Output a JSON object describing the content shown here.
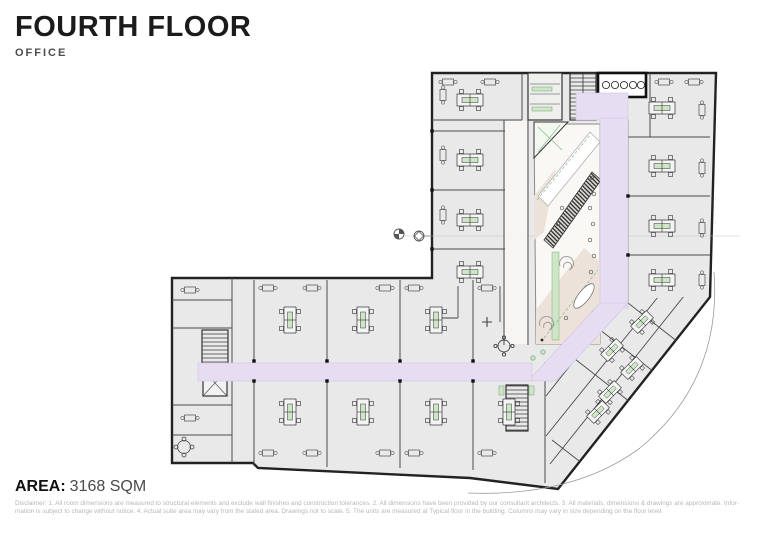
{
  "header": {
    "title": "FOURTH FLOOR",
    "subtitle": "OFFICE"
  },
  "footer": {
    "area_label": "AREA:",
    "area_value": "3168 SQM",
    "disclaimer_line1": "Disclaimer: 1. All room dimensions are measured to structural elements and exclude wall finishes and construction tolerances. 2. All dimensions have been provided by our consultant architects. 3. All materials, dimensions & drawings are approximate. Infor-",
    "disclaimer_line2": "mation is subject to change without notice. 4. Actual suite area may vary from the stated area. Drawings not to scale. 5. The units are measured at Typical floor in the building. Columns may vary in size depending on the floor level."
  },
  "plan": {
    "floor_name": "Fourth floor office plan",
    "colors": {
      "room": "#e9e9e9",
      "wall": "#2d2d2d",
      "line": "#4a4a4a",
      "corridor": "#e6ddf3",
      "corridoredge": "#cfc3e6",
      "atriumfloor": "#ede2d9",
      "atriumwhite": "#faf8f5",
      "green": "#cde6c5",
      "greendark": "#86b98a",
      "faint": "#c4c4c4"
    }
  }
}
